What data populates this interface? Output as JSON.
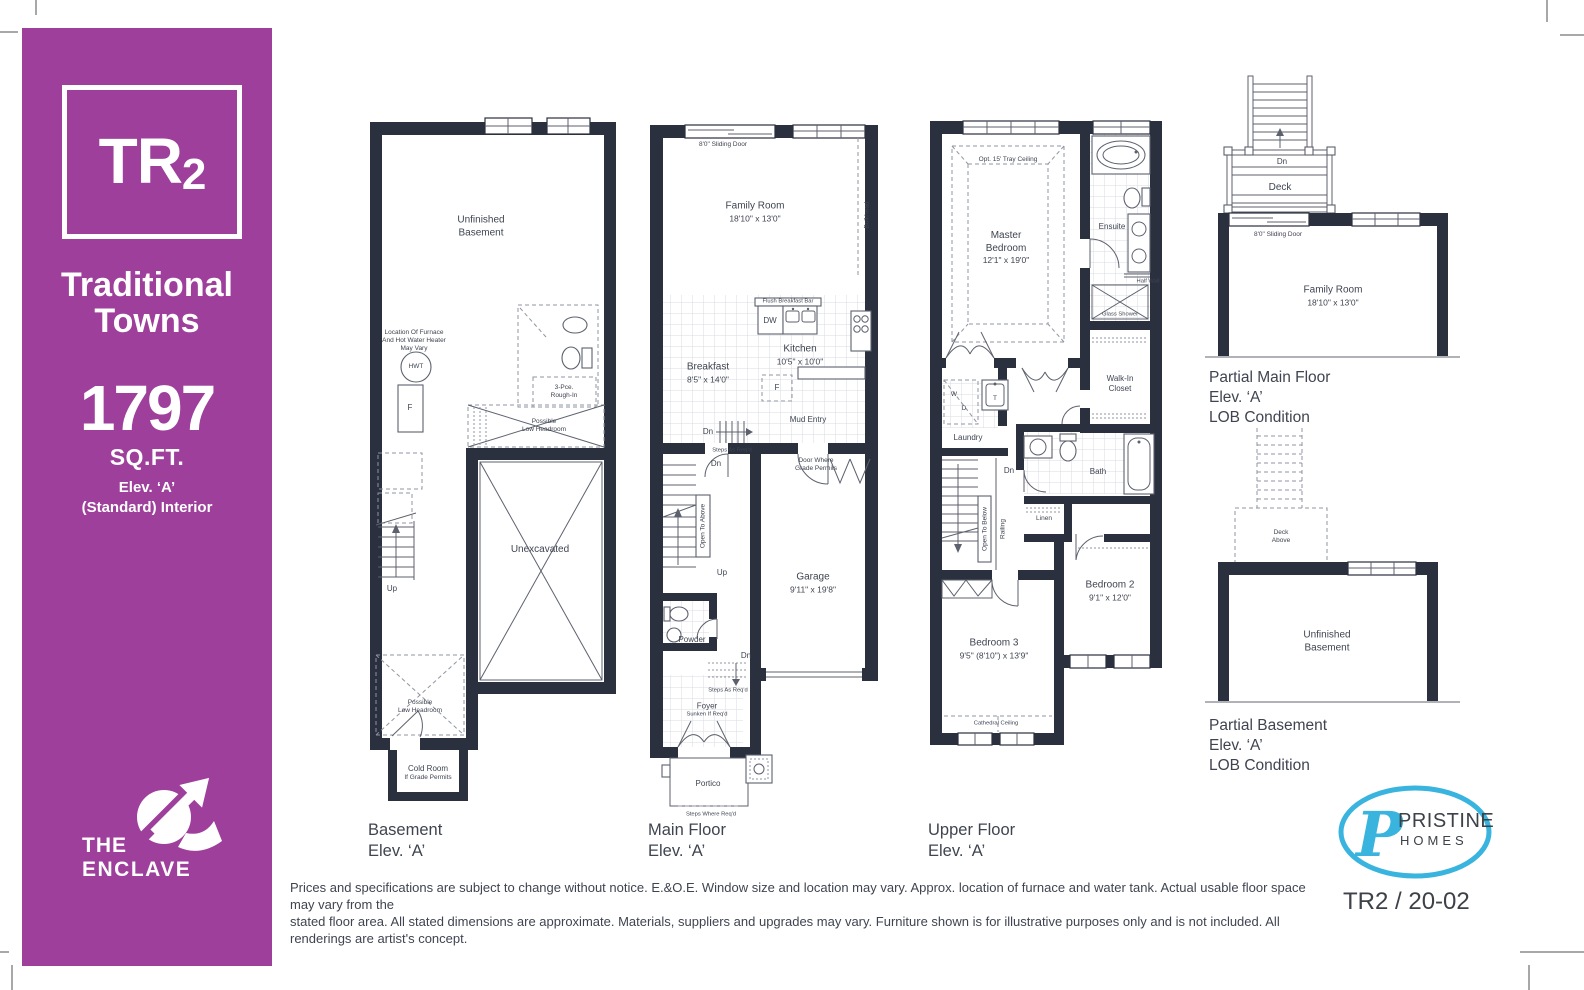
{
  "theme": {
    "accent": "#9d3f9b",
    "wall": "#2a303e",
    "logo_blue": "#39b4de"
  },
  "sidebar": {
    "model": "TR",
    "model_sub": "2",
    "series": [
      "Traditional",
      "Towns"
    ],
    "sqft": "1797",
    "sqft_label": "SQ.FT.",
    "elevation": "Elev. ‘A’",
    "interior": "(Standard) Interior",
    "community": [
      "THE",
      "ENCLAVE"
    ]
  },
  "plans": {
    "basement": {
      "caption": [
        "Basement",
        "Elev. ‘A’"
      ],
      "labels": {
        "unfinished": [
          "Unfinished",
          "Basement"
        ],
        "furnace_note": [
          "Location Of Furnace",
          "And Hot Water Heater",
          "May Vary"
        ],
        "hwt": "HWT",
        "furnace": "F",
        "rough_in": [
          "3-Pce.",
          "Rough-In"
        ],
        "low_headroom_a": [
          "Possible",
          "Low Headroom"
        ],
        "up": "Up",
        "unexcavated": "Unexcavated",
        "low_headroom_b": [
          "Possible",
          "Low Headroom"
        ],
        "cold_room": [
          "Cold Room",
          "If Grade Permits"
        ]
      }
    },
    "main_floor": {
      "caption": [
        "Main Floor",
        "Elev. ‘A’"
      ],
      "labels": {
        "sliding_door": "8'0\" Sliding Door",
        "family_room": [
          "Family Room",
          "18'10\" x 13'0\""
        ],
        "bulkhead": "Bulkhead",
        "flush_bar": "Flush Breakfast Bar",
        "dw": "DW",
        "kitchen": [
          "Kitchen",
          "10'5\" x 10'0\""
        ],
        "breakfast": [
          "Breakfast",
          "8'5\" x 14'0\""
        ],
        "fridge": "F",
        "mud_entry": "Mud Entry",
        "dn_a": "Dn",
        "steps_a": "Steps As Req'd",
        "door_grade": [
          "Door Where",
          "Grade Permits"
        ],
        "dn_b": "Dn",
        "open_above": "Open To Above",
        "up": "Up",
        "garage": [
          "Garage",
          "9'11\" x 19'8\""
        ],
        "powder": "Powder",
        "dn_c": "Dn",
        "steps_b": "Steps As Req'd",
        "foyer": [
          "Foyer",
          "Sunken If Req'd"
        ],
        "portico": "Portico",
        "steps_where": "Steps Where Req'd"
      }
    },
    "upper_floor": {
      "caption": [
        "Upper Floor",
        "Elev. ‘A’"
      ],
      "labels": {
        "tray": "Opt. 15' Tray Ceiling",
        "master": [
          "Master",
          "Bedroom",
          "12'1\" x 19'0\""
        ],
        "ensuite": "Ensuite",
        "half_wall": "Half Wall",
        "glass_shower": "Glass Shower",
        "walk_in": [
          "Walk-In",
          "Closet"
        ],
        "washer": "W",
        "dryer": "D",
        "tub": "T",
        "laundry": "Laundry",
        "dn": "Dn",
        "open_below": "Open To Below",
        "railing": "Railing",
        "bath": "Bath",
        "linen": "Linen",
        "bedroom2": [
          "Bedroom 2",
          "9'1\" x 12'0\""
        ],
        "bedroom3": [
          "Bedroom 3",
          "9'5\" (8'10\") x 13'9\""
        ],
        "cathedral": "Cathedral Ceiling"
      }
    },
    "partial_main": {
      "caption": [
        "Partial Main Floor",
        "Elev. ‘A’",
        "LOB Condition"
      ],
      "labels": {
        "dn": "Dn",
        "deck": "Deck",
        "sliding_door": "8'0\" Sliding Door",
        "family_room": [
          "Family Room",
          "18'10\" x 13'0\""
        ]
      }
    },
    "partial_basement": {
      "caption": [
        "Partial Basement",
        "Elev. ‘A’",
        "LOB Condition"
      ],
      "labels": {
        "deck_above": [
          "Deck",
          "Above"
        ],
        "unfinished": [
          "Unfinished",
          "Basement"
        ]
      }
    }
  },
  "footer": {
    "disclaimer": [
      "Prices and specifications are subject to change without notice. E.&O.E. Window size and location may vary. Approx. location of furnace and water tank. Actual usable floor space may vary from the",
      "stated floor area. All stated dimensions are approximate. Materials, suppliers and upgrades may vary. Furniture shown is for illustrative purposes only and is not included. All renderings are artist's concept."
    ],
    "plan_code": "TR2 / 20-02",
    "brand": {
      "initial": "P",
      "name": "PRISTINE",
      "sub": "HOMES"
    }
  }
}
